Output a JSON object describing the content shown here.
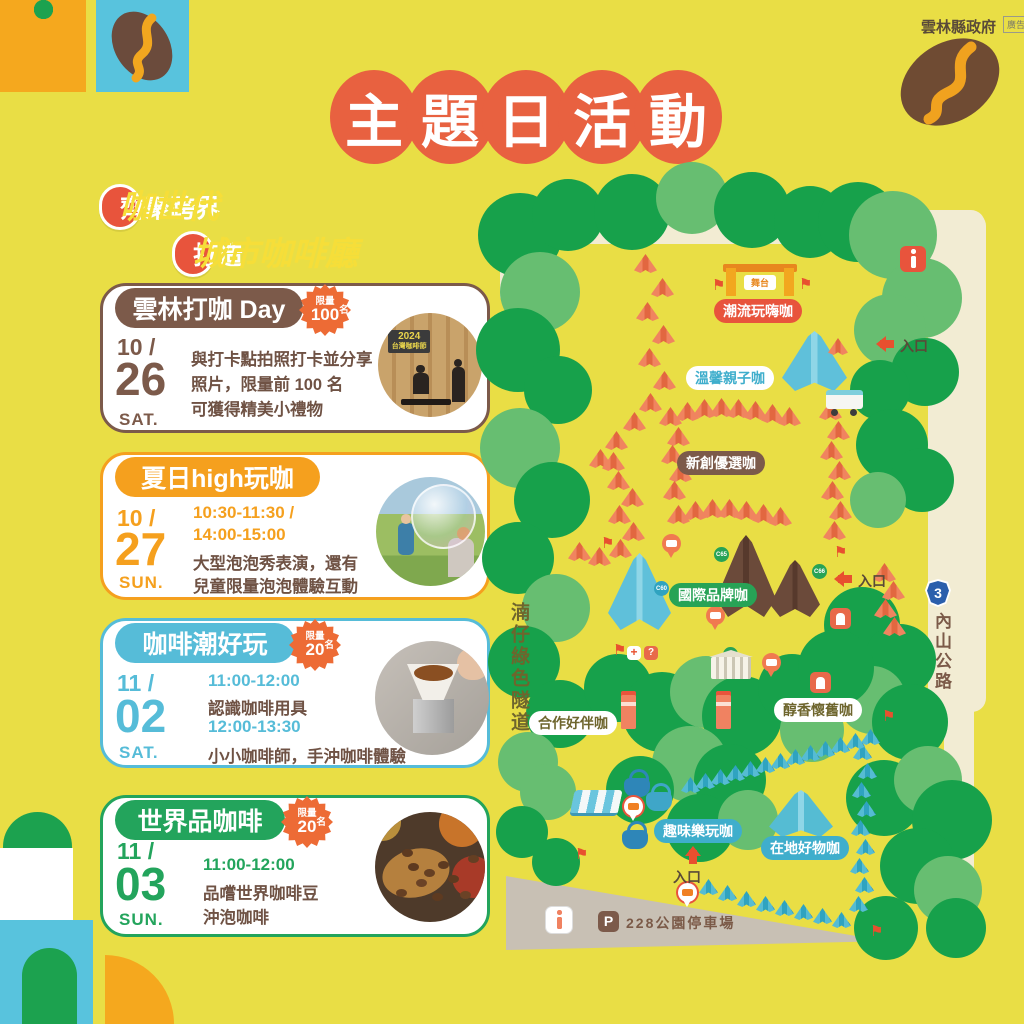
{
  "header": {
    "gov_label": "雲林縣政府",
    "ad_label": "廣告",
    "title": "主題日活動",
    "title_chars": [
      "主",
      "題",
      "日",
      "活",
      "動"
    ]
  },
  "subtitles": [
    {
      "prefix": "齊聚跨界",
      "highlight": "咖世代"
    },
    {
      "prefix": "打造",
      "highlight": "城市咖啡廳"
    }
  ],
  "colors": {
    "background": "#E9DE45",
    "title_circle": "#E86140",
    "badge_red": "#E8543C",
    "highlight_yellow": "#F6DE39",
    "brown": "#7C5A4A",
    "orange": "#F5A01E",
    "teal": "#56BCD8",
    "green": "#23A45C",
    "burst_orange": "#ED6B35",
    "desc_brown": "#6F5244",
    "tree_dark": "#17A14B",
    "tree_light": "#67BE71",
    "tent_orange": "#F0845F",
    "tent_teal": "#55BCD3",
    "road_cream": "#F2ECD3",
    "road_gray": "#C8C0B4",
    "shield_blue": "#2B5FAC"
  },
  "events": [
    {
      "theme": "brown",
      "title": "雲林打咖 Day",
      "limit_label": "限量",
      "limit_count": "100",
      "limit_unit": "名",
      "month": "10",
      "day": "26",
      "weekday": "SAT.",
      "lines": [
        {
          "style": "desc",
          "text": "與打卡點拍照打卡並分享"
        },
        {
          "style": "desc",
          "text": "照片，限量前 100 名"
        },
        {
          "style": "desc",
          "text": "可獲得精美小禮物"
        }
      ],
      "photo": "checkin",
      "photo_sign": "2024 台灣咖啡節"
    },
    {
      "theme": "orange",
      "title": "夏日high玩咖",
      "month": "10",
      "day": "27",
      "weekday": "SUN.",
      "lines": [
        {
          "style": "time",
          "text": "10:30-11:30 /"
        },
        {
          "style": "time",
          "text": "14:00-15:00"
        },
        {
          "style": "desc",
          "text": "大型泡泡秀表演，還有"
        },
        {
          "style": "desc",
          "text": "兒童限量泡泡體驗互動"
        }
      ],
      "photo": "bubbles"
    },
    {
      "theme": "teal",
      "title": "咖啡潮好玩",
      "limit_label": "限量",
      "limit_count": "20",
      "limit_unit": "名",
      "month": "11",
      "day": "02",
      "weekday": "SAT.",
      "lines": [
        {
          "style": "time",
          "text": "11:00-12:00"
        },
        {
          "style": "desc",
          "text": "認識咖啡用具"
        },
        {
          "style": "time",
          "text": "12:00-13:30"
        },
        {
          "style": "desc",
          "text": "小小咖啡師，手沖咖啡體驗"
        }
      ],
      "photo": "pourover"
    },
    {
      "theme": "green",
      "title": "世界品咖啡",
      "limit_label": "限量",
      "limit_count": "20",
      "limit_unit": "名",
      "month": "11",
      "day": "03",
      "weekday": "SUN.",
      "lines": [
        {
          "style": "time",
          "text": "11:00-12:00"
        },
        {
          "style": "desc",
          "text": "品嚐世界咖啡豆"
        },
        {
          "style": "desc",
          "text": "沖泡咖啡"
        }
      ],
      "photo": "beans"
    }
  ],
  "map": {
    "stage_label": "舞台",
    "left_road": "湳仔綠色隧道",
    "right_road": "內山公路",
    "route_number": "3",
    "entrance_label": "入口",
    "parking_icon": "P",
    "parking_label": "228公園停車場",
    "areas": [
      {
        "id": "trend",
        "label": "潮流玩嗨咖",
        "variant": "red-solid",
        "x": 714,
        "y": 299
      },
      {
        "id": "family",
        "label": "溫馨親子咖",
        "variant": "white-teal",
        "x": 686,
        "y": 366
      },
      {
        "id": "startup",
        "label": "新創優選咖",
        "variant": "brown-solid",
        "x": 677,
        "y": 451
      },
      {
        "id": "intl",
        "label": "國際品牌咖",
        "variant": "green-solid",
        "x": 669,
        "y": 583
      },
      {
        "id": "coop",
        "label": "合作好伴咖",
        "variant": "white-olive",
        "x": 529,
        "y": 711
      },
      {
        "id": "nostalgia",
        "label": "醇香懷舊咖",
        "variant": "white-olive",
        "x": 774,
        "y": 698
      },
      {
        "id": "fun",
        "label": "趣味樂玩咖",
        "variant": "teal-solid",
        "x": 654,
        "y": 819
      },
      {
        "id": "local",
        "label": "在地好物咖",
        "variant": "teal-solid",
        "x": 761,
        "y": 836
      }
    ],
    "entrances": [
      {
        "x": 870,
        "y": 336,
        "dir": "left"
      },
      {
        "x": 828,
        "y": 571,
        "dir": "left"
      },
      {
        "x": 680,
        "y": 845,
        "dir": "up"
      }
    ],
    "trees": [
      [
        520,
        235,
        42,
        "d"
      ],
      [
        568,
        215,
        36,
        "d"
      ],
      [
        540,
        292,
        40,
        "l"
      ],
      [
        518,
        350,
        42,
        "d"
      ],
      [
        558,
        390,
        34,
        "d"
      ],
      [
        520,
        448,
        40,
        "l"
      ],
      [
        552,
        500,
        38,
        "d"
      ],
      [
        518,
        558,
        36,
        "d"
      ],
      [
        556,
        608,
        34,
        "l"
      ],
      [
        524,
        662,
        36,
        "d"
      ],
      [
        560,
        714,
        34,
        "d"
      ],
      [
        528,
        762,
        30,
        "l"
      ],
      [
        632,
        212,
        38,
        "d"
      ],
      [
        692,
        198,
        36,
        "l"
      ],
      [
        752,
        210,
        38,
        "d"
      ],
      [
        810,
        222,
        36,
        "d"
      ],
      [
        858,
        222,
        40,
        "d"
      ],
      [
        893,
        235,
        44,
        "l"
      ],
      [
        922,
        298,
        40,
        "l"
      ],
      [
        890,
        330,
        36,
        "l"
      ],
      [
        925,
        372,
        34,
        "d"
      ],
      [
        880,
        390,
        30,
        "d"
      ],
      [
        892,
        445,
        36,
        "d"
      ],
      [
        922,
        480,
        32,
        "d"
      ],
      [
        878,
        500,
        28,
        "l"
      ],
      [
        862,
        625,
        38,
        "d"
      ],
      [
        900,
        660,
        36,
        "d"
      ],
      [
        872,
        700,
        34,
        "l"
      ],
      [
        910,
        722,
        38,
        "d"
      ],
      [
        618,
        688,
        34,
        "d"
      ],
      [
        662,
        712,
        40,
        "d"
      ],
      [
        706,
        692,
        36,
        "l"
      ],
      [
        742,
        716,
        40,
        "d"
      ],
      [
        690,
        764,
        38,
        "l"
      ],
      [
        640,
        790,
        34,
        "d"
      ],
      [
        730,
        780,
        36,
        "d"
      ],
      [
        700,
        828,
        34,
        "d"
      ],
      [
        748,
        820,
        30,
        "l"
      ],
      [
        792,
        688,
        34,
        "d"
      ],
      [
        836,
        668,
        38,
        "d"
      ],
      [
        812,
        730,
        32,
        "l"
      ],
      [
        548,
        792,
        28,
        "l"
      ],
      [
        522,
        832,
        26,
        "d"
      ],
      [
        556,
        862,
        24,
        "d"
      ],
      [
        884,
        798,
        38,
        "d"
      ],
      [
        928,
        780,
        34,
        "l"
      ],
      [
        952,
        820,
        40,
        "d"
      ],
      [
        918,
        866,
        38,
        "d"
      ],
      [
        948,
        890,
        34,
        "l"
      ],
      [
        956,
        928,
        30,
        "d"
      ],
      [
        886,
        928,
        32,
        "d"
      ]
    ],
    "tents": [
      [
        "C01",
        645,
        263,
        "c"
      ],
      [
        "C02",
        662,
        287,
        "c"
      ],
      [
        "C03",
        647,
        311,
        "c"
      ],
      [
        "C04",
        663,
        334,
        "c"
      ],
      [
        "C05",
        649,
        357,
        "c"
      ],
      [
        "C06",
        664,
        380,
        "c"
      ],
      [
        "C07",
        650,
        402,
        "c"
      ],
      [
        "C08",
        634,
        421,
        "c"
      ],
      [
        "C09",
        616,
        440,
        "c"
      ],
      [
        "C10",
        600,
        458,
        "c"
      ],
      [
        "C11",
        613,
        461,
        "c"
      ],
      [
        "C12",
        618,
        480,
        "c"
      ],
      [
        "C13",
        632,
        497,
        "c"
      ],
      [
        "C14",
        619,
        514,
        "c"
      ],
      [
        "C15",
        633,
        531,
        "c"
      ],
      [
        "C16",
        620,
        548,
        "c"
      ],
      [
        "C17",
        599,
        556,
        "c"
      ],
      [
        "C18",
        579,
        551,
        "c"
      ],
      [
        "C24",
        670,
        416,
        "c"
      ],
      [
        "C25",
        687,
        411,
        "c"
      ],
      [
        "C26",
        704,
        408,
        "c"
      ],
      [
        "C27",
        721,
        407,
        "c"
      ],
      [
        "C28",
        738,
        408,
        "c"
      ],
      [
        "C29",
        755,
        410,
        "c"
      ],
      [
        "C30",
        772,
        413,
        "c"
      ],
      [
        "C31",
        789,
        416,
        "c"
      ],
      [
        "C32",
        678,
        436,
        "c"
      ],
      [
        "C33",
        672,
        454,
        "c"
      ],
      [
        "C34",
        680,
        472,
        "c"
      ],
      [
        "C35",
        674,
        490,
        "c"
      ],
      [
        "C37",
        678,
        514,
        "c"
      ],
      [
        "C38",
        695,
        510,
        "c"
      ],
      [
        "C39",
        712,
        508,
        "c"
      ],
      [
        "C40",
        729,
        508,
        "c"
      ],
      [
        "C41",
        746,
        510,
        "c"
      ],
      [
        "C42",
        763,
        513,
        "c"
      ],
      [
        "C43",
        780,
        516,
        "c"
      ],
      [
        "C44",
        830,
        410,
        "c"
      ],
      [
        "C45",
        838,
        430,
        "c"
      ],
      [
        "C46",
        831,
        450,
        "c"
      ],
      [
        "C47",
        839,
        470,
        "c"
      ],
      [
        "C48",
        832,
        490,
        "c"
      ],
      [
        "C49",
        840,
        510,
        "c"
      ],
      [
        "C50",
        834,
        530,
        "c"
      ],
      [
        "C61",
        884,
        572,
        "c"
      ],
      [
        "C62",
        893,
        590,
        "c"
      ],
      [
        "C63",
        885,
        608,
        "c"
      ],
      [
        "C64",
        894,
        626,
        "c"
      ],
      [
        "A01",
        710,
        888,
        "a"
      ],
      [
        "A02",
        729,
        894,
        "a"
      ],
      [
        "A03",
        748,
        900,
        "a"
      ],
      [
        "A04",
        767,
        905,
        "a"
      ],
      [
        "A05",
        786,
        909,
        "a"
      ],
      [
        "A06",
        805,
        913,
        "a"
      ],
      [
        "A07",
        824,
        917,
        "a"
      ],
      [
        "A08",
        843,
        921,
        "a"
      ],
      [
        "A09",
        860,
        905,
        "a"
      ],
      [
        "A10",
        866,
        886,
        "a"
      ],
      [
        "A11",
        861,
        867,
        "a"
      ],
      [
        "A12",
        867,
        848,
        "a"
      ],
      [
        "A13",
        862,
        829,
        "a"
      ],
      [
        "A14",
        868,
        810,
        "a"
      ],
      [
        "A15",
        863,
        791,
        "a"
      ],
      [
        "A16",
        869,
        772,
        "a"
      ],
      [
        "A17",
        864,
        753,
        "a"
      ],
      [
        "A18",
        872,
        738,
        "a"
      ],
      [
        "A19",
        857,
        742,
        "a"
      ],
      [
        "A20",
        842,
        746,
        "a"
      ],
      [
        "A21",
        827,
        750,
        "a"
      ],
      [
        "A22",
        812,
        754,
        "a"
      ],
      [
        "A23",
        797,
        758,
        "a"
      ],
      [
        "A24",
        782,
        762,
        "a"
      ],
      [
        "A25",
        767,
        766,
        "a"
      ],
      [
        "A26",
        752,
        770,
        "a"
      ],
      [
        "A27",
        737,
        774,
        "a"
      ],
      [
        "A28",
        722,
        778,
        "a"
      ],
      [
        "A29",
        707,
        782,
        "a"
      ],
      [
        "A30",
        692,
        786,
        "a"
      ]
    ],
    "big_tents": [
      {
        "x": 782,
        "y": 331,
        "w": 65,
        "h": 60,
        "kind": "blue"
      },
      {
        "x": 828,
        "y": 338,
        "w": 20,
        "h": 17,
        "kind": "orange-small"
      },
      {
        "x": 608,
        "y": 553,
        "w": 63,
        "h": 77,
        "kind": "blue",
        "id": "C60",
        "dot": "t",
        "dx": 46,
        "dy": 28
      },
      {
        "x": 716,
        "y": 535,
        "w": 60,
        "h": 82,
        "kind": "brown",
        "id": "C65",
        "dot": "g",
        "dx": -2,
        "dy": 12
      },
      {
        "x": 770,
        "y": 560,
        "w": 50,
        "h": 57,
        "kind": "brown",
        "id": "C66",
        "dot": "g",
        "dx": 42,
        "dy": 4
      },
      {
        "x": 769,
        "y": 790,
        "w": 64,
        "h": 47,
        "kind": "teal2"
      }
    ],
    "building_id": "C68",
    "canopy_id": "A31",
    "flags": [
      [
        712,
        278
      ],
      [
        799,
        277
      ],
      [
        834,
        545
      ],
      [
        613,
        643
      ],
      [
        575,
        847
      ],
      [
        882,
        709
      ],
      [
        870,
        924
      ],
      [
        601,
        536
      ]
    ],
    "pins": [
      {
        "x": 662,
        "y": 534,
        "kind": "orange"
      },
      {
        "x": 706,
        "y": 606,
        "kind": "orange"
      },
      {
        "x": 762,
        "y": 653,
        "kind": "orange"
      },
      {
        "x": 624,
        "y": 797,
        "kind": "white"
      },
      {
        "x": 678,
        "y": 883,
        "kind": "white"
      }
    ],
    "booths": [
      [
        830,
        608
      ],
      [
        810,
        672
      ]
    ],
    "vending": [
      [
        621,
        695
      ],
      [
        716,
        695
      ]
    ],
    "medical_symbol": "+",
    "help_symbol": "?"
  }
}
